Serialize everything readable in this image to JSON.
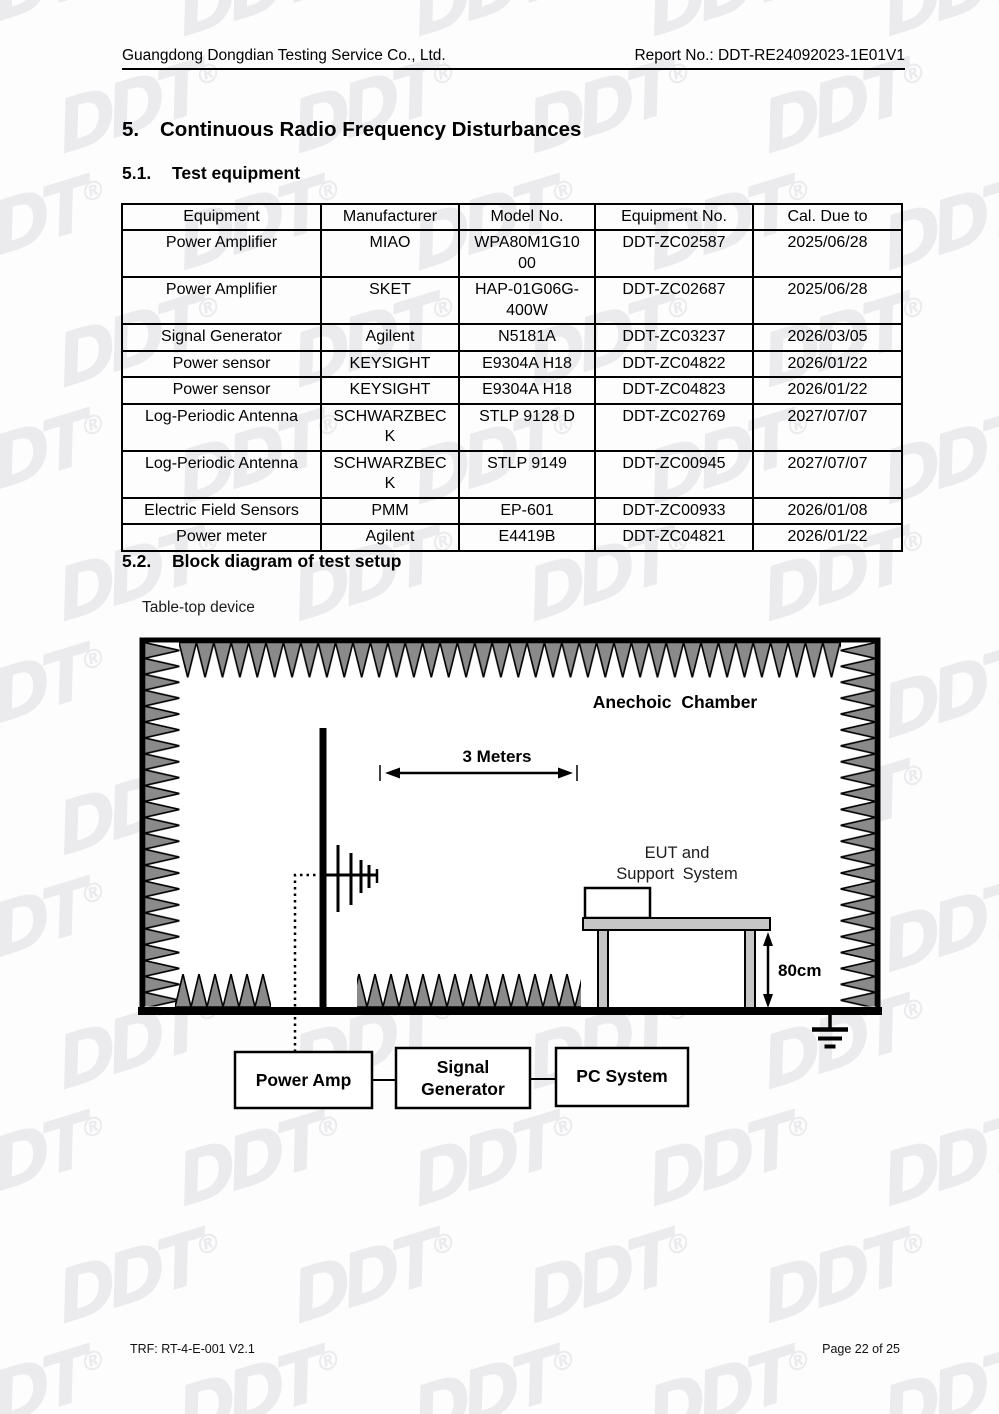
{
  "header": {
    "company": "Guangdong Dongdian Testing Service Co., Ltd.",
    "report_no": "Report No.: DDT-RE24092023-1E01V1"
  },
  "section5": {
    "number": "5.",
    "title": "Continuous Radio Frequency Disturbances"
  },
  "section51": {
    "number": "5.1.",
    "title": "Test equipment"
  },
  "section52": {
    "number": "5.2.",
    "title": "Block diagram of test setup"
  },
  "equipment_table": {
    "columns": [
      "Equipment",
      "Manufacturer",
      "Model No.",
      "Equipment No.",
      "Cal. Due to"
    ],
    "rows": [
      [
        "Power Amplifier",
        "MIAO",
        "WPA80M1G1000",
        "DDT-ZC02587",
        "2025/06/28"
      ],
      [
        "Power Amplifier",
        "SKET",
        "HAP-01G06G-400W",
        "DDT-ZC02687",
        "2025/06/28"
      ],
      [
        "Signal Generator",
        "Agilent",
        "N5181A",
        "DDT-ZC03237",
        "2026/03/05"
      ],
      [
        "Power sensor",
        "KEYSIGHT",
        "E9304A H18",
        "DDT-ZC04822",
        "2026/01/22"
      ],
      [
        "Power sensor",
        "KEYSIGHT",
        "E9304A H18",
        "DDT-ZC04823",
        "2026/01/22"
      ],
      [
        "Log-Periodic Antenna",
        "SCHWARZBECK",
        "STLP 9128 D",
        "DDT-ZC02769",
        "2027/07/07"
      ],
      [
        "Log-Periodic Antenna",
        "SCHWARZBECK",
        "STLP 9149",
        "DDT-ZC00945",
        "2027/07/07"
      ],
      [
        "Electric Field Sensors",
        "PMM",
        "EP-601",
        "DDT-ZC00933",
        "2026/01/08"
      ],
      [
        "Power meter",
        "Agilent",
        "E4419B",
        "DDT-ZC04821",
        "2026/01/22"
      ]
    ]
  },
  "diagram": {
    "device_type_label": "Table-top device",
    "chamber_label": "Anechoic Chamber",
    "distance_label": "3 Meters",
    "eut_label_line1": "EUT and",
    "eut_label_line2": "Support System",
    "table_height_label": "80cm",
    "power_amp_label": "Power Amp",
    "signal_generator_line1": "Signal",
    "signal_generator_line2": "Generator",
    "pc_system_label": "PC System"
  },
  "footer": {
    "left": "TRF: RT-4-E-001 V2.1",
    "right": "Page 22 of 25"
  },
  "watermark": {
    "text": "DDT",
    "registered": "®",
    "color": "#ebebee"
  },
  "colors": {
    "absorber_fill": "#8a8a8a",
    "surface_fill": "#c6c6c6",
    "line": "#000000"
  }
}
